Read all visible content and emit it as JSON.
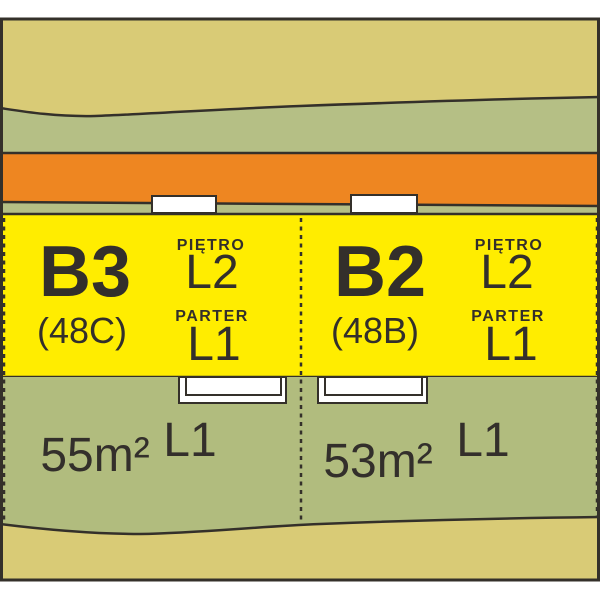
{
  "colors": {
    "outline": "#34302a",
    "text": "#332f2b",
    "field_far": "#d9cb76",
    "greenbelt": "#b5bf85",
    "road": "#ee8621",
    "building": "#ffed00",
    "garden": "#b1bc7e",
    "marker": "#ffffff"
  },
  "units": [
    {
      "id": "B3",
      "code": "(48C)",
      "floors": [
        {
          "label": "PIĘTRO",
          "value": "L2"
        },
        {
          "label": "PARTER",
          "value": "L1"
        }
      ],
      "garden": {
        "area": "55m²",
        "level": "L1"
      }
    },
    {
      "id": "B2",
      "code": "(48B)",
      "floors": [
        {
          "label": "PIĘTRO",
          "value": "L2"
        },
        {
          "label": "PARTER",
          "value": "L1"
        }
      ],
      "garden": {
        "area": "53m²",
        "level": "L1"
      }
    }
  ]
}
